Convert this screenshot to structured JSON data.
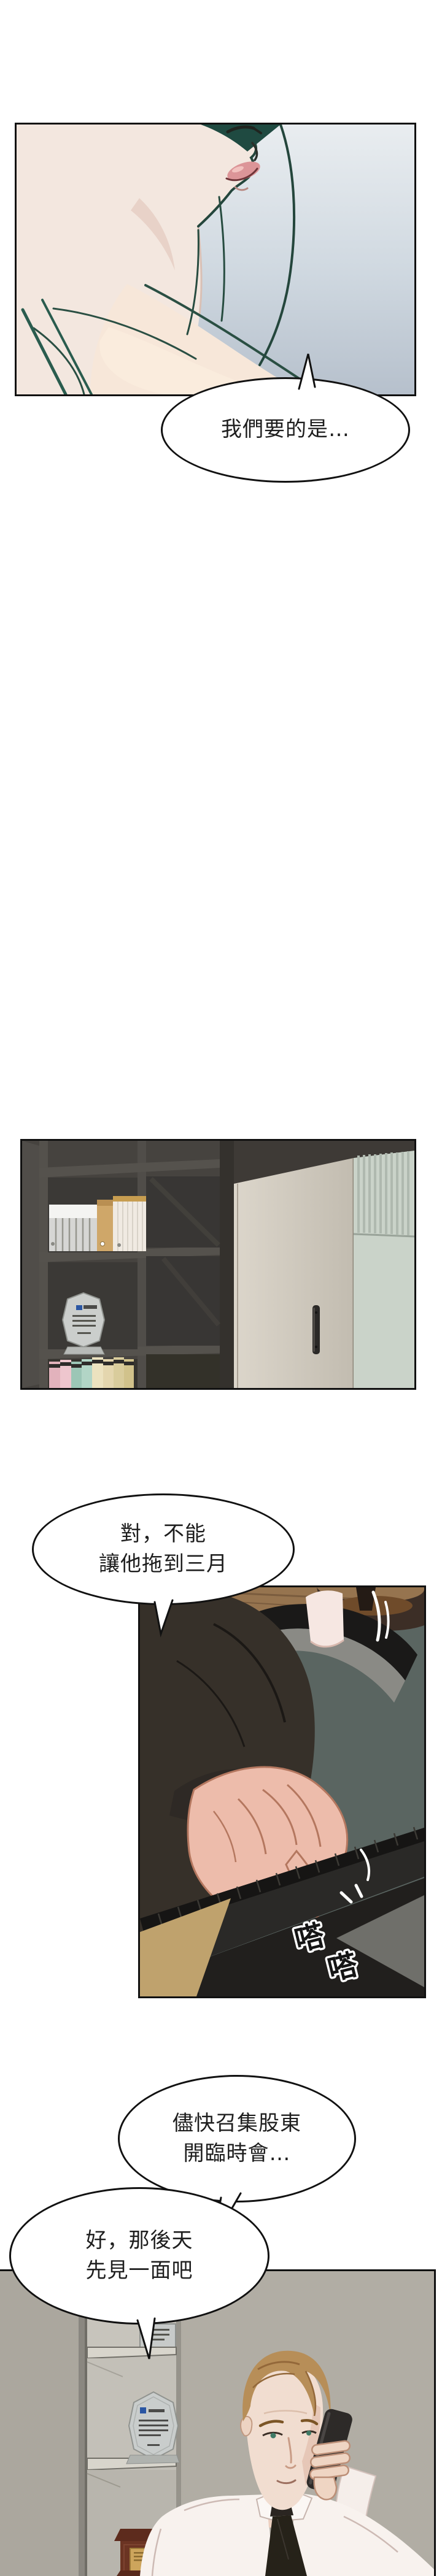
{
  "page": {
    "type": "webtoon-strip",
    "background": "#ffffff",
    "ink": "#111111",
    "palette": {
      "panel1_bg_top": "#e9edf0",
      "panel1_bg_bottom": "#b6c0cc",
      "skin_light": "#f3e7df",
      "hair_teal": "#1f4a41",
      "lips_pink": "#dc9598",
      "shelf_dark": "#4e4b48",
      "shelf_interior": "#3a3837",
      "binder_beige": "#cfa769",
      "door_beige": "#d9d3c8",
      "wall_green": "#cad3c9",
      "panel3_bg": "#5a6561",
      "floor_wood": "#96744f",
      "suit_dark": "#363029",
      "hand_skin": "#edbcab",
      "keyboard_dark": "#2a2927",
      "desk_tan": "#bfa26d",
      "panel4_wall": "#aba79e",
      "trophy_wood": "#6b3423",
      "trophy_gold": "#cda55c",
      "man_hair": "#b78e58",
      "shirt_white": "#f8f2ee",
      "tie_dark": "#262219",
      "plaque_silver": "#c9cdcc",
      "plaque_blue": "#2a56a3"
    }
  },
  "bubbles": {
    "b1": {
      "lines": [
        "我們要的是…"
      ]
    },
    "b2": {
      "lines": [
        "對，不能",
        "讓他拖到三月"
      ]
    },
    "b3": {
      "lines": [
        "儘快召集股東",
        "開臨時會…"
      ]
    },
    "b4": {
      "lines": [
        "好，那後天",
        "先見一面吧"
      ]
    }
  },
  "sfx": {
    "typing1": "嗒",
    "typing2": "嗒"
  }
}
